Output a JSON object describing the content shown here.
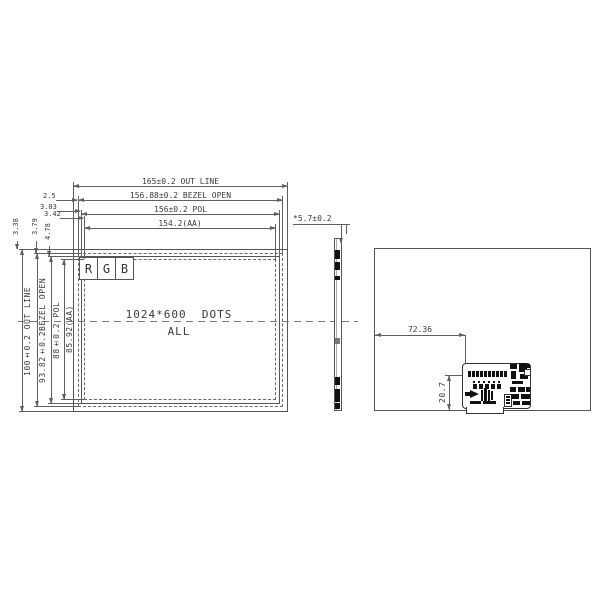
{
  "front_view": {
    "top_dims": [
      "165±0.2 OUT LINE",
      "156.88±0.2 BEZEL OPEN",
      "156±0.2 POL",
      "154.2(AA)"
    ],
    "left_dims": [
      "100±0.2 OUT LINE",
      "93.82±0.2BEZEL OPEN",
      "88±0.2 POL",
      "85.92(AA)"
    ],
    "offset_dims_horizontal": [
      "2.5",
      "3.03",
      "3.42"
    ],
    "offset_dims_vertical": [
      "3.38",
      "3.79",
      "4.78"
    ],
    "pixel_cells": [
      "R",
      "G",
      "B"
    ],
    "resolution_line1": "1024*600  DOTS",
    "resolution_line2": "ALL"
  },
  "side_view": {
    "thickness": "*5.7±0.2"
  },
  "rear_view": {
    "pcb_offset_x": "72.36",
    "pcb_offset_y": "20.7"
  },
  "colors": {
    "line": "#5f5f5f",
    "text": "#3a3a3a",
    "component": "#111111"
  }
}
